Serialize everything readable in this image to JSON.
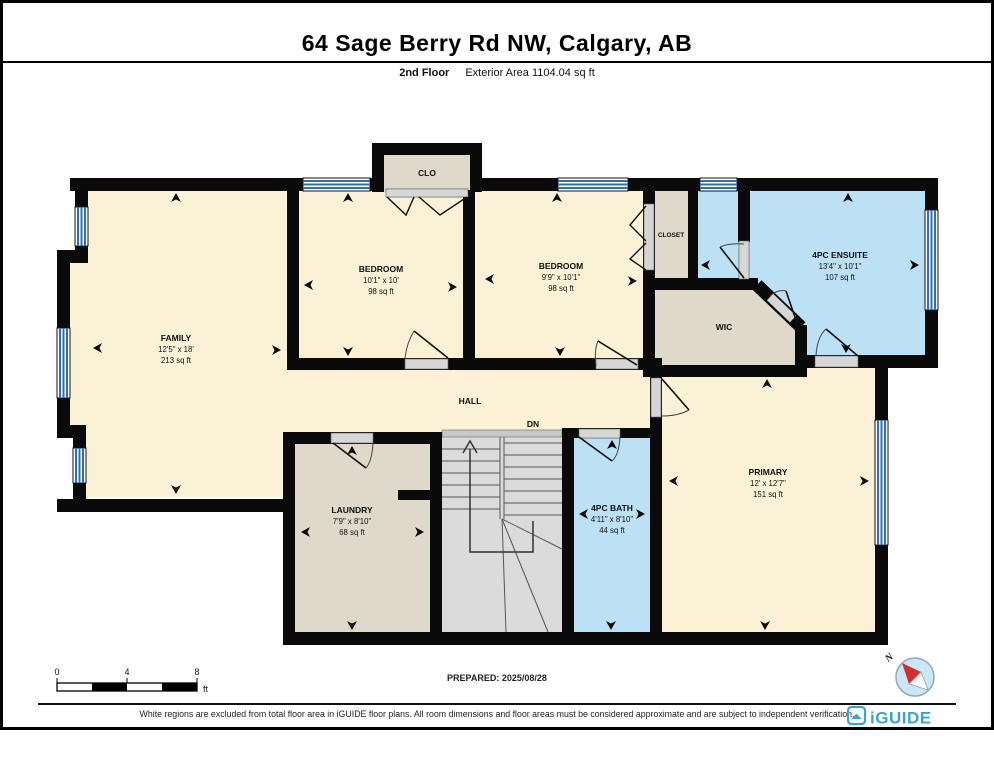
{
  "header": {
    "title": "64 Sage Berry Rd NW, Calgary, AB",
    "floor_label": "2nd Floor",
    "area_label": "Exterior Area 1104.04 sq ft"
  },
  "rooms": {
    "family": {
      "name": "FAMILY",
      "dims": "12'5\" x 18'",
      "area": "213 sq ft"
    },
    "bedroom1": {
      "name": "BEDROOM",
      "dims": "10'1\" x 10'",
      "area": "98 sq ft"
    },
    "bedroom2": {
      "name": "BEDROOM",
      "dims": "9'9\" x 10'1\"",
      "area": "98 sq ft"
    },
    "ensuite": {
      "name": "4PC ENSUITE",
      "dims": "13'4\" x 10'1\"",
      "area": "107 sq ft"
    },
    "clo": {
      "name": "CLO"
    },
    "closet": {
      "name": "CLOSET"
    },
    "wic": {
      "name": "WIC"
    },
    "hall": {
      "name": "HALL"
    },
    "stairs": {
      "name": "DN"
    },
    "laundry": {
      "name": "LAUNDRY",
      "dims": "7'9\" x 8'10\"",
      "area": "68 sq ft"
    },
    "bath": {
      "name": "4PC BATH",
      "dims": "4'11\" x 8'10\"",
      "area": "44 sq ft"
    },
    "primary": {
      "name": "PRIMARY",
      "dims": "12' x 12'7\"",
      "area": "151 sq ft"
    }
  },
  "scale_bar": {
    "ticks": [
      "0",
      "4",
      "8"
    ],
    "unit": "ft"
  },
  "prepared": "PREPARED: 2025/08/28",
  "compass": {
    "label": "N"
  },
  "footer": {
    "disclaimer": "White regions are excluded from total floor area in iGUIDE floor plans. All room dimensions and floor areas must be considered approximate and are subject to independent verification.",
    "brand": "iGUIDE"
  },
  "colors": {
    "cream": "#FAF1D6",
    "blue": "#BCE0F4",
    "warm_grey": "#DFD9CC",
    "stair_grey": "#DBDBDB",
    "wall": "#0a0a0a",
    "window_blue": "#2F6FB2",
    "threshold": "#D6D6D6",
    "brand": "#3EA3C8",
    "compass_fill": "#C9E7F6",
    "needle_red": "#D92B2B"
  }
}
